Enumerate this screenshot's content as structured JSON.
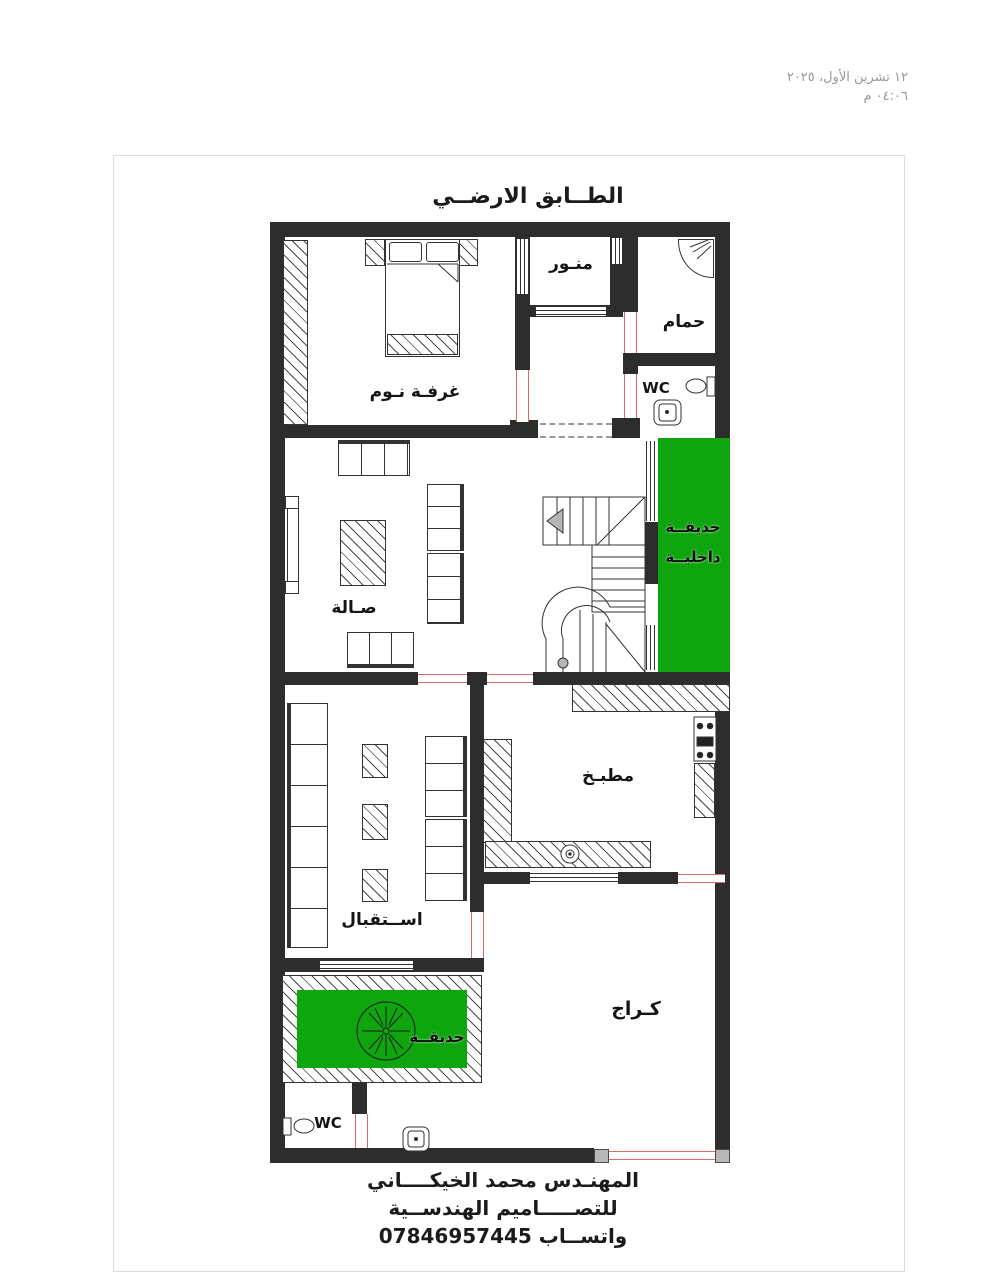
{
  "meta": {
    "date_line1": "١٢ تشرين الأول، ٢٠٢٥",
    "date_line2": "٠٤:٠٦ م"
  },
  "title": "الطــابق الارضــي",
  "rooms": {
    "bedroom": "غرفـة نـوم",
    "lightwell": "منـور",
    "bathroom": "حمام",
    "wc_top": "WC",
    "hall": "صـالة",
    "inner_garden_line1": "حديقــة",
    "inner_garden_line2": "داخليــة",
    "kitchen": "مطبـخ",
    "reception": "اســتقبال",
    "garage": "كـراج",
    "garden": "حديقــة",
    "wc_bottom": "WC"
  },
  "footer": {
    "line1": "المهنـدس محمد الخيكــــاني",
    "line2": "للتصـــــاميم الهندســية",
    "line3": "واتســاب 07846957445"
  },
  "colors": {
    "wall": "#2d2d2d",
    "door": "#d96b6b",
    "garden_green": "#0ea50e",
    "page_border": "#dcdcdc",
    "date_text": "#979797"
  }
}
